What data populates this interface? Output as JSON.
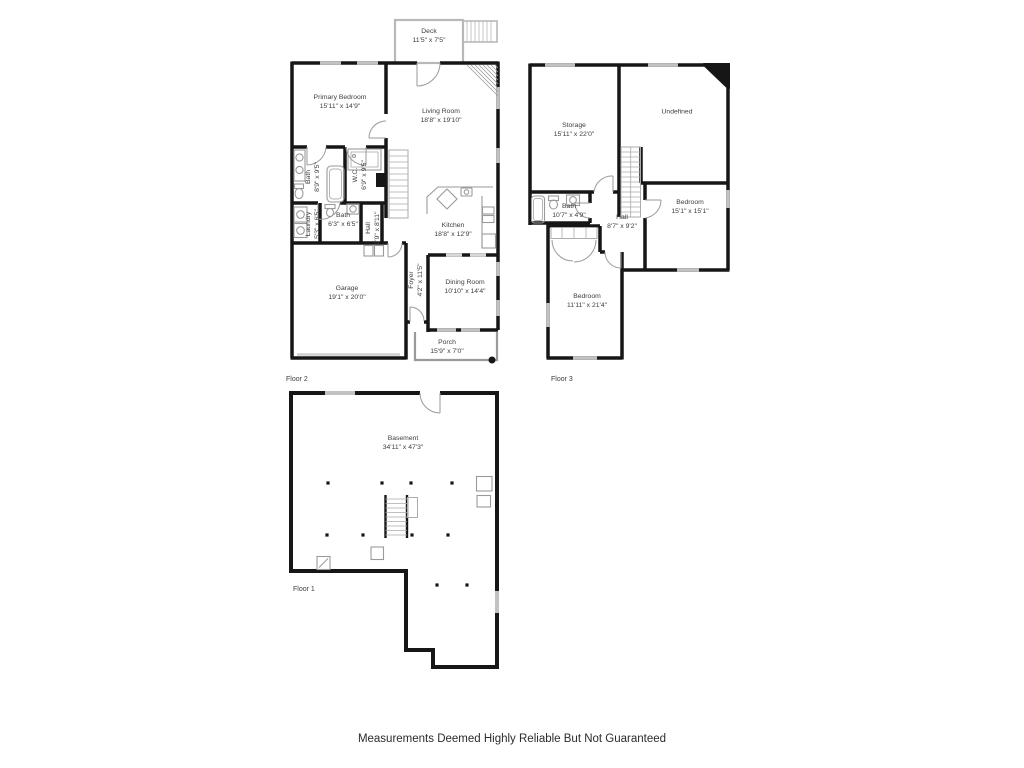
{
  "footer": {
    "disclaimer": "Measurements Deemed Highly Reliable But Not Guaranteed"
  },
  "colors": {
    "wall": "#161616",
    "window": "#c2c2c2",
    "fixture": "#9a9a9a",
    "label_text": "#3d3d3d"
  },
  "floors": [
    {
      "caption": "Floor 2",
      "rooms": [
        {
          "name": "Deck",
          "dims": "11'5\" x 7'5\""
        },
        {
          "name": "Primary Bedroom",
          "dims": "15'11\" x 14'9\""
        },
        {
          "name": "Living Room",
          "dims": "18'8\" x 19'10\""
        },
        {
          "name": "Bath",
          "dims": "8'9\" x 9'5\""
        },
        {
          "name": "W.C.",
          "dims": "6'9\" x 9'5\""
        },
        {
          "name": "Laundry",
          "dims": "5'3\" x 6'5\""
        },
        {
          "name": "Bath",
          "dims": "6'3\" x 6'5\""
        },
        {
          "name": "Hall",
          "dims": "2'9\" x 8'11\""
        },
        {
          "name": "Kitchen",
          "dims": "18'8\" x 12'9\""
        },
        {
          "name": "Foyer",
          "dims": "4'2\" x 11'5\""
        },
        {
          "name": "Garage",
          "dims": "19'1\" x 20'0\""
        },
        {
          "name": "Dining Room",
          "dims": "10'10\" x 14'4\""
        },
        {
          "name": "Porch",
          "dims": "15'9\" x 7'0\""
        }
      ]
    },
    {
      "caption": "Floor 3",
      "rooms": [
        {
          "name": "Storage",
          "dims": "15'11\" x 22'0\""
        },
        {
          "name": "Undefined",
          "dims": ""
        },
        {
          "name": "Bath",
          "dims": "10'7\" x 4'9\""
        },
        {
          "name": "Hall",
          "dims": "8'7\" x 9'2\""
        },
        {
          "name": "Bedroom",
          "dims": "15'1\" x 15'1\""
        },
        {
          "name": "Bedroom",
          "dims": "11'11\" x 21'4\""
        }
      ]
    },
    {
      "caption": "Floor 1",
      "rooms": [
        {
          "name": "Basement",
          "dims": "34'11\" x 47'3\""
        }
      ]
    }
  ]
}
